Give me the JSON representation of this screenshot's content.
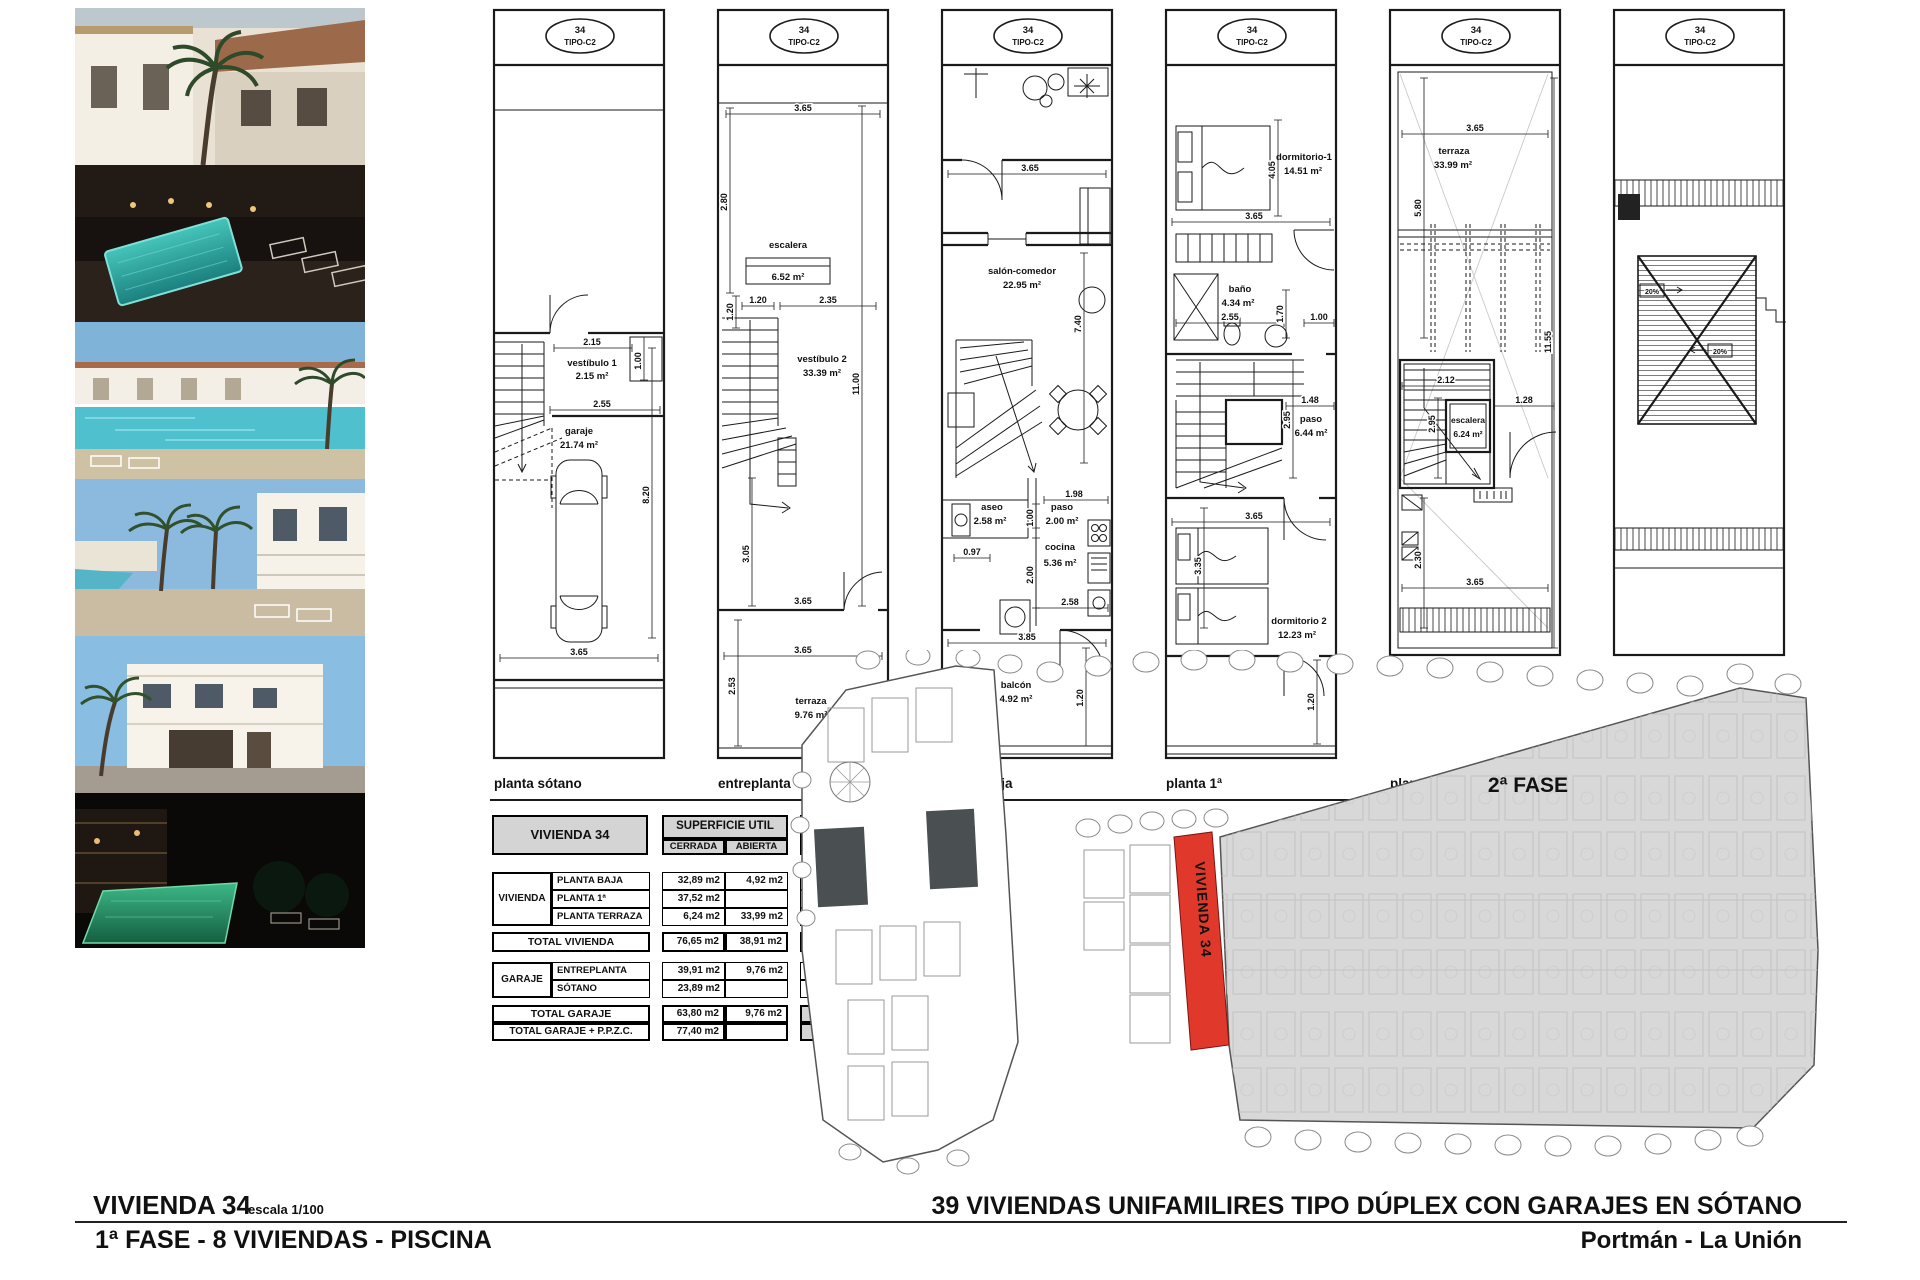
{
  "sheet": {
    "title": "VIVIENDA 34",
    "scale": "escala 1/100",
    "phase_line": "1ª FASE - 8 VIVIENDAS - PISCINA",
    "project_title": "39 VIVIENDAS UNIFAMILIRES TIPO DÚPLEX CON GARAJES EN SÓTANO",
    "location": "Portmán - La Unión"
  },
  "badge": {
    "number": "34",
    "type": "TIPO-C2"
  },
  "plans": [
    {
      "caption": "planta sótano",
      "rooms": [
        {
          "name": "vestíbulo 1",
          "area": "2.15 m²"
        },
        {
          "name": "garaje",
          "area": "21.74 m²"
        }
      ],
      "dims": [
        "2.15",
        "1.00",
        "2.55",
        "3.65",
        "8.20"
      ]
    },
    {
      "caption": "entreplanta",
      "rooms": [
        {
          "name": "escalera",
          "area": "6.52 m²"
        },
        {
          "name": "vestíbulo 2",
          "area": "33.39 m²"
        },
        {
          "name": "terraza",
          "area": "9.76 m²"
        }
      ],
      "dims": [
        "3.65",
        "2.80",
        "1.20",
        "1.20",
        "2.35",
        "11.00",
        "3.05",
        "3.65",
        "2.53",
        "3.65"
      ]
    },
    {
      "caption": "planta baja",
      "rooms": [
        {
          "name": "salón-comedor",
          "area": "22.95 m²"
        },
        {
          "name": "aseo",
          "area": "2.58 m²"
        },
        {
          "name": "paso",
          "area": "2.00 m²"
        },
        {
          "name": "cocina",
          "area": "5.36 m²"
        },
        {
          "name": "balcón",
          "area": "4.92 m²"
        }
      ],
      "dims": [
        "3.65",
        "7.40",
        "1.98",
        "1.00",
        "0.97",
        "2.00",
        "2.58",
        "3.85",
        "1.20"
      ]
    },
    {
      "caption": "planta 1ª",
      "rooms": [
        {
          "name": "dormitorio-1",
          "area": "14.51 m²"
        },
        {
          "name": "baño",
          "area": "4.34 m²"
        },
        {
          "name": "paso",
          "area": "6.44 m²"
        },
        {
          "name": "dormitorio 2",
          "area": "12.23 m²"
        }
      ],
      "dims": [
        "4.05",
        "3.65",
        "2.55",
        "1.00",
        "1.70",
        "1.48",
        "2.95",
        "3.65",
        "3.35",
        "1.20"
      ]
    },
    {
      "caption": "planta terraza",
      "rooms": [
        {
          "name": "terraza",
          "area": "33.99 m²"
        },
        {
          "name": "escalera",
          "area": "6.24 m²"
        }
      ],
      "dims": [
        "3.65",
        "5.80",
        "11.55",
        "2.12",
        "1.28",
        "2.95",
        "2.30",
        "3.65"
      ]
    },
    {
      "caption": "planta cubierta",
      "rooms": [],
      "dims": [
        "20%",
        "20%"
      ]
    }
  ],
  "table": {
    "title": "VIVIENDA 34",
    "col_util": "SUPERFICIE UTIL",
    "col_cerrada": "CERRADA",
    "col_abierta": "ABIERTA",
    "col_construida": "SUPERFICIE CONSTRUIDA",
    "group_vivienda": "VIVIENDA",
    "group_garaje": "GARAJE",
    "rows": [
      {
        "label": "PLANTA BAJA",
        "cerrada": "32,89 m2",
        "abierta": "4,92 m2",
        "construida": "43,60 m2"
      },
      {
        "label": "PLANTA 1ª",
        "cerrada": "37,52 m2",
        "abierta": "",
        "construida": "48,83 m2"
      },
      {
        "label": "PLANTA TERRAZA",
        "cerrada": "6,24 m2",
        "abierta": "33,99 m2",
        "construida": "8,42 m2"
      }
    ],
    "total_vivienda": {
      "label": "TOTAL VIVIENDA",
      "cerrada": "76,65 m2",
      "abierta": "38,91 m2",
      "construida": "100,85 m2"
    },
    "garaje_rows": [
      {
        "label": "ENTREPLANTA",
        "cerrada": "39,91 m2",
        "abierta": "9,76 m2",
        "construida": "43,71 m2"
      },
      {
        "label": "SÓTANO",
        "cerrada": "23,89 m2",
        "abierta": "",
        "construida": "29,50 m2"
      }
    ],
    "total_garaje": {
      "label": "TOTAL GARAJE",
      "cerrada": "63,80 m2",
      "abierta": "9,76 m2",
      "construida": "73,21 m2"
    },
    "total_garaje_ppzc": {
      "label": "TOTAL GARAJE + P.P.Z.C.",
      "cerrada": "77,40 m2",
      "abierta": "",
      "construida": "87,55 m2"
    }
  },
  "siteplan": {
    "phase_label": "2ª FASE",
    "highlight_label": "VIVIENDA 34",
    "highlight_color": "#e0392b"
  }
}
